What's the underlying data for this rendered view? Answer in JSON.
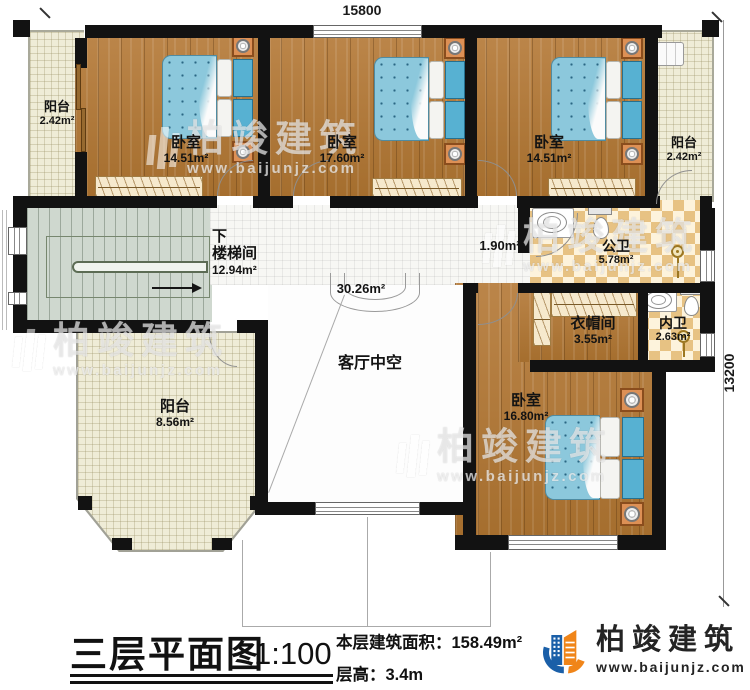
{
  "dimensions": {
    "width": "15800",
    "height": "13200"
  },
  "rooms": {
    "balcony_tl": {
      "name": "阳台",
      "area": "2.42m²"
    },
    "bedroom1": {
      "name": "卧室",
      "area": "14.51m²"
    },
    "bedroom2": {
      "name": "卧室",
      "area": "17.60m²"
    },
    "bedroom3": {
      "name": "卧室",
      "area": "14.51m²"
    },
    "balcony_tr": {
      "name": "阳台",
      "area": "2.42m²"
    },
    "stairwell": {
      "down": "下",
      "name": "楼梯间",
      "area": "12.94m²"
    },
    "hallway": {
      "area": "30.26m²"
    },
    "vestibule": {
      "area": "1.90m²"
    },
    "public_bath": {
      "name": "公卫",
      "area": "5.78m²"
    },
    "cloakroom": {
      "name": "衣帽间",
      "area": "3.55m²"
    },
    "ensuite_bath": {
      "name": "内卫",
      "area": "2.63m²"
    },
    "bedroom4": {
      "name": "卧室",
      "area": "16.80m²"
    },
    "balcony_b": {
      "name": "阳台",
      "area": "8.56m²"
    },
    "living_void": {
      "name": "客厅中空"
    }
  },
  "title_block": {
    "title": "三层平面图",
    "scale": "1:100",
    "floor_area_label": "本层建筑面积：",
    "floor_area_value": "158.49m²",
    "floor_height_label": "层高：",
    "floor_height_value": "3.4m"
  },
  "brand": {
    "name": "柏竣建筑",
    "website": "www.baijunjz.com"
  },
  "colors": {
    "wall": "#121212",
    "wood": "#b1793c",
    "tile_cream": "#efecd7",
    "checker_tan": "#e7c283",
    "bed_blue": "#8cc8dc",
    "logo_blue": "#1a5fa8",
    "logo_orange": "#f08519"
  }
}
